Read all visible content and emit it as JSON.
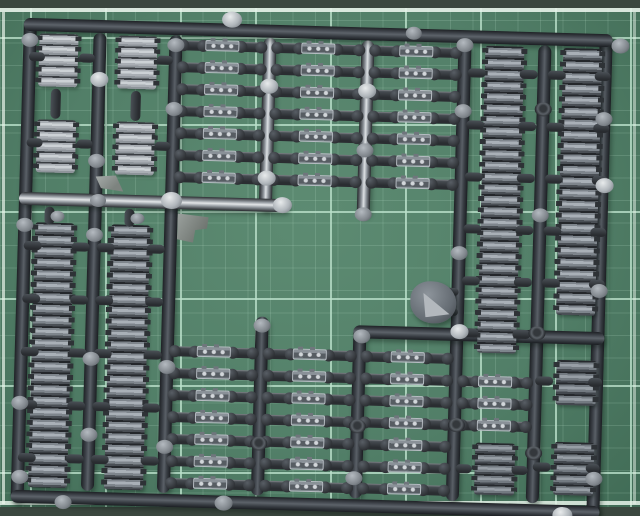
{
  "scene": {
    "description": "Photograph of a dark grey injection-moulded model kit sprue of tank track links lying on a green cutting mat with a light grid"
  },
  "mat": {
    "grid_spacing": 45,
    "grid_offset_x": 30,
    "grid_offset_y": 42,
    "grid_color": "rgba(186,224,202,0.8)",
    "subgrid_color": "rgba(186,224,202,0.18)",
    "edge_band_color": "#3b473f",
    "edge_line_color": "#e8f3ea",
    "top_band_h": 8,
    "top_line_y": 8,
    "bottom_line_y": 501,
    "bottom_band_y": 507,
    "left_line_x": 2,
    "right_line_x": 633
  },
  "sprue": {
    "rotation_deg": 1.6,
    "bar_thickness": 13,
    "runners_v": [
      {
        "name": "frame-left-bar",
        "x": 30,
        "y": 18,
        "h": 484,
        "sheen": false
      },
      {
        "name": "frame-right-bar",
        "x": 606,
        "y": 18,
        "h": 484,
        "sheen": false
      },
      {
        "name": "runner-v1",
        "x": 100,
        "y": 31,
        "h": 458,
        "sheen": false
      },
      {
        "name": "runner-v2",
        "x": 176,
        "y": 31,
        "h": 458,
        "sheen": false
      },
      {
        "name": "runner-v3-top",
        "x": 270,
        "y": 31,
        "h": 173,
        "sheen": true
      },
      {
        "name": "runner-v3-bottom",
        "x": 270,
        "y": 310,
        "h": 179,
        "sheen": false
      },
      {
        "name": "runner-v4-top",
        "x": 368,
        "y": 31,
        "h": 176,
        "sheen": true
      },
      {
        "name": "runner-v4-bottom",
        "x": 368,
        "y": 316,
        "h": 173,
        "sheen": false
      },
      {
        "name": "runner-v5",
        "x": 465,
        "y": 31,
        "h": 458,
        "sheen": false
      },
      {
        "name": "runner-v6",
        "x": 545,
        "y": 31,
        "h": 458,
        "sheen": false
      }
    ],
    "runners_h": [
      {
        "name": "frame-top-bar",
        "y": 24,
        "x": 24,
        "w": 589,
        "sheen": false
      },
      {
        "name": "frame-bottom-bar",
        "y": 496,
        "x": 24,
        "w": 589,
        "sheen": false
      },
      {
        "name": "runner-mid-left",
        "y": 198,
        "x": 24,
        "w": 270,
        "sheen": true
      },
      {
        "name": "runner-mid-right",
        "y": 322,
        "x": 362,
        "w": 251,
        "sheen": false
      }
    ],
    "track_runs": [
      {
        "name": "track-run-left-outer",
        "x": 41,
        "y": 222,
        "w": 39,
        "h": 265,
        "links": 23,
        "tone": "steel"
      },
      {
        "name": "track-run-left-inner",
        "x": 117,
        "y": 222,
        "w": 39,
        "h": 265,
        "links": 23,
        "tone": "steel"
      },
      {
        "name": "track-run-right-inner",
        "x": 486,
        "y": 33,
        "w": 39,
        "h": 307,
        "links": 27,
        "tone": "steel"
      },
      {
        "name": "track-run-right-outer",
        "x": 564,
        "y": 33,
        "w": 39,
        "h": 267,
        "links": 23,
        "tone": "steel"
      }
    ],
    "segment_blocks": [
      {
        "x": 40,
        "y": 33,
        "w": 39,
        "h": 53,
        "rows": 5,
        "tone": "bright"
      },
      {
        "x": 119,
        "y": 33,
        "w": 39,
        "h": 53,
        "rows": 5,
        "tone": "bright"
      },
      {
        "x": 40,
        "y": 119,
        "w": 39,
        "h": 53,
        "rows": 5,
        "tone": "bright"
      },
      {
        "x": 119,
        "y": 119,
        "w": 39,
        "h": 53,
        "rows": 5,
        "tone": "bright"
      },
      {
        "x": 487,
        "y": 430,
        "w": 40,
        "h": 52,
        "rows": 5,
        "tone": "mid"
      },
      {
        "x": 566,
        "y": 345,
        "w": 40,
        "h": 45,
        "rows": 4,
        "tone": "mid"
      },
      {
        "x": 566,
        "y": 427,
        "w": 40,
        "h": 53,
        "rows": 5,
        "tone": "mid"
      }
    ],
    "link_size": {
      "w": 34,
      "h": 11
    },
    "ladders": [
      {
        "name": "top-ladder",
        "ys": [
          40,
          62,
          84,
          106,
          128,
          150,
          172
        ],
        "bays": [
          [
            183,
            80
          ],
          [
            277,
            84
          ],
          [
            375,
            83
          ]
        ]
      },
      {
        "name": "bottom-ladder",
        "ys": [
          346,
          368,
          390,
          412,
          434,
          456,
          478
        ],
        "bays": [
          [
            183,
            80
          ],
          [
            277,
            84
          ],
          [
            375,
            83
          ]
        ]
      },
      {
        "name": "bottom-right-ladder",
        "ys": [
          368,
          390,
          412
        ],
        "bays": [
          [
            472,
            66
          ]
        ]
      }
    ],
    "stubs": [
      {
        "x": 30,
        "y": 241,
        "w": 18,
        "h": 9
      },
      {
        "x": 30,
        "y": 294,
        "w": 18,
        "h": 9
      },
      {
        "x": 30,
        "y": 347,
        "w": 18,
        "h": 9
      },
      {
        "x": 30,
        "y": 400,
        "w": 18,
        "h": 9
      },
      {
        "x": 30,
        "y": 453,
        "w": 18,
        "h": 9
      },
      {
        "x": 78,
        "y": 241,
        "w": 18,
        "h": 9
      },
      {
        "x": 78,
        "y": 294,
        "w": 18,
        "h": 9
      },
      {
        "x": 78,
        "y": 347,
        "w": 18,
        "h": 9
      },
      {
        "x": 78,
        "y": 400,
        "w": 18,
        "h": 9
      },
      {
        "x": 78,
        "y": 453,
        "w": 18,
        "h": 9
      },
      {
        "x": 103,
        "y": 241,
        "w": 18,
        "h": 9
      },
      {
        "x": 103,
        "y": 294,
        "w": 18,
        "h": 9
      },
      {
        "x": 103,
        "y": 347,
        "w": 18,
        "h": 9
      },
      {
        "x": 103,
        "y": 400,
        "w": 18,
        "h": 9
      },
      {
        "x": 103,
        "y": 453,
        "w": 18,
        "h": 9
      },
      {
        "x": 153,
        "y": 241,
        "w": 18,
        "h": 9
      },
      {
        "x": 153,
        "y": 294,
        "w": 18,
        "h": 9
      },
      {
        "x": 153,
        "y": 347,
        "w": 18,
        "h": 9
      },
      {
        "x": 153,
        "y": 400,
        "w": 18,
        "h": 9
      },
      {
        "x": 153,
        "y": 453,
        "w": 18,
        "h": 9
      },
      {
        "x": 469,
        "y": 56,
        "w": 18,
        "h": 9
      },
      {
        "x": 469,
        "y": 108,
        "w": 18,
        "h": 9
      },
      {
        "x": 469,
        "y": 160,
        "w": 18,
        "h": 9
      },
      {
        "x": 469,
        "y": 212,
        "w": 18,
        "h": 9
      },
      {
        "x": 469,
        "y": 264,
        "w": 18,
        "h": 9
      },
      {
        "x": 469,
        "y": 316,
        "w": 18,
        "h": 9
      },
      {
        "x": 521,
        "y": 56,
        "w": 18,
        "h": 9
      },
      {
        "x": 521,
        "y": 108,
        "w": 18,
        "h": 9
      },
      {
        "x": 521,
        "y": 160,
        "w": 18,
        "h": 9
      },
      {
        "x": 521,
        "y": 212,
        "w": 18,
        "h": 9
      },
      {
        "x": 521,
        "y": 264,
        "w": 18,
        "h": 9
      },
      {
        "x": 521,
        "y": 316,
        "w": 18,
        "h": 9
      },
      {
        "x": 549,
        "y": 56,
        "w": 18,
        "h": 9
      },
      {
        "x": 549,
        "y": 108,
        "w": 18,
        "h": 9
      },
      {
        "x": 549,
        "y": 160,
        "w": 18,
        "h": 9
      },
      {
        "x": 549,
        "y": 212,
        "w": 18,
        "h": 9
      },
      {
        "x": 549,
        "y": 264,
        "w": 18,
        "h": 9
      },
      {
        "x": 596,
        "y": 56,
        "w": 16,
        "h": 9
      },
      {
        "x": 596,
        "y": 108,
        "w": 16,
        "h": 9
      },
      {
        "x": 596,
        "y": 160,
        "w": 16,
        "h": 9
      },
      {
        "x": 596,
        "y": 212,
        "w": 16,
        "h": 9
      },
      {
        "x": 596,
        "y": 264,
        "w": 16,
        "h": 9
      },
      {
        "x": 53,
        "y": 88,
        "w": 10,
        "h": 30,
        "v": true
      },
      {
        "x": 133,
        "y": 88,
        "w": 10,
        "h": 30,
        "v": true
      },
      {
        "x": 80,
        "y": 52,
        "w": 16,
        "h": 9
      },
      {
        "x": 80,
        "y": 138,
        "w": 16,
        "h": 9
      },
      {
        "x": 158,
        "y": 52,
        "w": 16,
        "h": 9
      },
      {
        "x": 158,
        "y": 138,
        "w": 16,
        "h": 9
      },
      {
        "x": 30,
        "y": 52,
        "w": 16,
        "h": 9
      },
      {
        "x": 30,
        "y": 138,
        "w": 16,
        "h": 9
      },
      {
        "x": 545,
        "y": 362,
        "w": 18,
        "h": 9
      },
      {
        "x": 545,
        "y": 448,
        "w": 18,
        "h": 9
      },
      {
        "x": 598,
        "y": 362,
        "w": 14,
        "h": 9
      },
      {
        "x": 598,
        "y": 448,
        "w": 14,
        "h": 9
      },
      {
        "x": 468,
        "y": 452,
        "w": 16,
        "h": 9
      },
      {
        "x": 524,
        "y": 452,
        "w": 16,
        "h": 9
      },
      {
        "x": 452,
        "y": 276,
        "w": 14,
        "h": 8
      },
      {
        "x": 452,
        "y": 296,
        "w": 14,
        "h": 8
      },
      {
        "x": 50,
        "y": 206,
        "w": 10,
        "h": 18,
        "v": true
      },
      {
        "x": 130,
        "y": 206,
        "w": 10,
        "h": 18,
        "v": true
      }
    ],
    "gate_bumps": [
      {
        "x": 222,
        "y": 6,
        "s": "bright",
        "d": 20
      },
      {
        "x": 612,
        "y": 22,
        "s": "grey",
        "d": 18
      },
      {
        "x": 406,
        "y": 16,
        "s": "grey",
        "d": 16
      },
      {
        "x": 22,
        "y": 33,
        "s": "grey",
        "d": 17
      },
      {
        "x": 22,
        "y": 218,
        "s": "grey",
        "d": 17
      },
      {
        "x": 22,
        "y": 396,
        "s": "grey",
        "d": 17
      },
      {
        "x": 24,
        "y": 470,
        "s": "grey",
        "d": 17
      },
      {
        "x": 68,
        "y": 494,
        "s": "grey",
        "d": 17
      },
      {
        "x": 228,
        "y": 490,
        "s": "grey",
        "d": 18
      },
      {
        "x": 566,
        "y": 492,
        "s": "bright",
        "d": 20
      },
      {
        "x": 92,
        "y": 70,
        "s": "bright",
        "d": 18
      },
      {
        "x": 92,
        "y": 152,
        "s": "grey",
        "d": 17
      },
      {
        "x": 92,
        "y": 226,
        "s": "grey",
        "d": 17
      },
      {
        "x": 92,
        "y": 350,
        "s": "grey",
        "d": 17
      },
      {
        "x": 92,
        "y": 426,
        "s": "grey",
        "d": 17
      },
      {
        "x": 168,
        "y": 34,
        "s": "grey",
        "d": 17
      },
      {
        "x": 168,
        "y": 98,
        "s": "grey",
        "d": 17
      },
      {
        "x": 166,
        "y": 188,
        "s": "bright",
        "d": 21
      },
      {
        "x": 168,
        "y": 356,
        "s": "grey",
        "d": 17
      },
      {
        "x": 168,
        "y": 436,
        "s": "grey",
        "d": 17
      },
      {
        "x": 262,
        "y": 72,
        "s": "bright",
        "d": 18
      },
      {
        "x": 262,
        "y": 164,
        "s": "bright",
        "d": 18
      },
      {
        "x": 278,
        "y": 190,
        "s": "bright",
        "d": 19
      },
      {
        "x": 262,
        "y": 312,
        "s": "grey",
        "d": 17
      },
      {
        "x": 262,
        "y": 430,
        "s": "ring",
        "d": 17
      },
      {
        "x": 360,
        "y": 74,
        "s": "bright",
        "d": 18
      },
      {
        "x": 360,
        "y": 134,
        "s": "grey",
        "d": 17
      },
      {
        "x": 360,
        "y": 198,
        "s": "grey",
        "d": 17
      },
      {
        "x": 362,
        "y": 320,
        "s": "grey",
        "d": 17
      },
      {
        "x": 360,
        "y": 410,
        "s": "ring",
        "d": 17
      },
      {
        "x": 358,
        "y": 462,
        "s": "grey",
        "d": 17
      },
      {
        "x": 457,
        "y": 26,
        "s": "grey",
        "d": 17
      },
      {
        "x": 457,
        "y": 92,
        "s": "grey",
        "d": 17
      },
      {
        "x": 457,
        "y": 234,
        "s": "grey",
        "d": 17
      },
      {
        "x": 459,
        "y": 312,
        "s": "bright",
        "d": 18
      },
      {
        "x": 459,
        "y": 406,
        "s": "ring",
        "d": 17
      },
      {
        "x": 537,
        "y": 88,
        "s": "ring",
        "d": 17
      },
      {
        "x": 537,
        "y": 194,
        "s": "grey",
        "d": 17
      },
      {
        "x": 537,
        "y": 312,
        "s": "ring",
        "d": 17
      },
      {
        "x": 537,
        "y": 432,
        "s": "ring",
        "d": 17
      },
      {
        "x": 598,
        "y": 96,
        "s": "grey",
        "d": 17
      },
      {
        "x": 600,
        "y": 162,
        "s": "bright",
        "d": 18
      },
      {
        "x": 598,
        "y": 268,
        "s": "grey",
        "d": 17
      },
      {
        "x": 598,
        "y": 456,
        "s": "grey",
        "d": 17
      },
      {
        "x": 95,
        "y": 192,
        "s": "grey",
        "d": 16
      },
      {
        "x": 56,
        "y": 210,
        "s": "grey",
        "d": 14
      },
      {
        "x": 136,
        "y": 210,
        "s": "grey",
        "d": 14
      }
    ],
    "misc_parts": [
      {
        "type": "flat1",
        "name": "flat-bracket-part-a",
        "x": 100,
        "y": 173,
        "w": 28,
        "h": 16
      },
      {
        "type": "flat2",
        "name": "flat-bracket-part-b",
        "x": 183,
        "y": 208,
        "w": 31,
        "h": 30
      },
      {
        "type": "blob",
        "name": "small-hull-part",
        "x": 418,
        "y": 270,
        "w": 46,
        "h": 42
      }
    ],
    "tones": {
      "steel": {
        "gap": "#24272b",
        "mid": "#7e858c",
        "lite": "#a9b0b7",
        "dark": "#4a4f55"
      },
      "bright": {
        "gap": "#3a3e43",
        "mid": "#a9aeb4",
        "lite": "#ccd1d5",
        "dark": "#8e949a"
      },
      "mid": {
        "gap": "#26292d",
        "mid": "#737a81",
        "lite": "#979ea5",
        "dark": "#43484e"
      }
    }
  }
}
